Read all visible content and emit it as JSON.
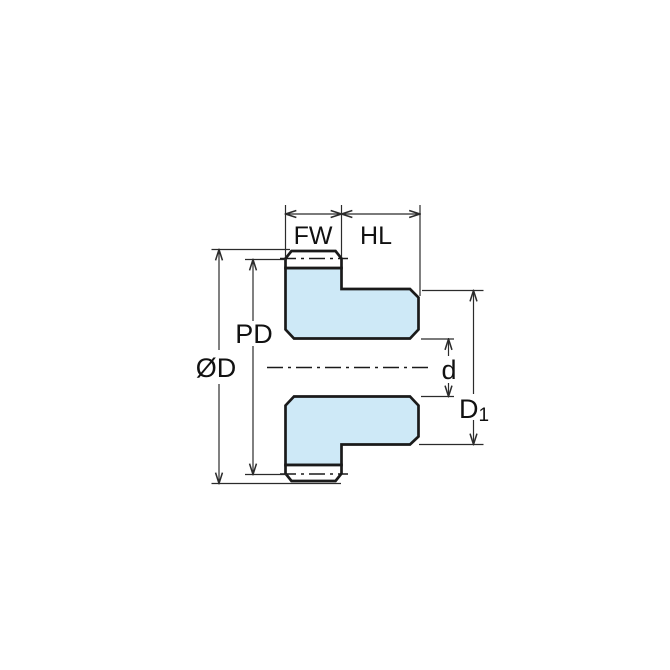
{
  "figure": {
    "kind": "gear-cross-section-dimension-drawing"
  },
  "labels": {
    "face_width": "FW",
    "hub_length": "HL",
    "pitch_diameter": "PD",
    "outside_diameter": "ØD",
    "bore_diameter": "d",
    "hub_diameter_main": "D",
    "hub_diameter_sub": "1"
  },
  "colors": {
    "part_fill": "#cee9f7",
    "tooth_fill": "#ffffff",
    "line": "#1a1a1a",
    "dimension_line": "#2b2b2b",
    "background": "#ffffff"
  }
}
